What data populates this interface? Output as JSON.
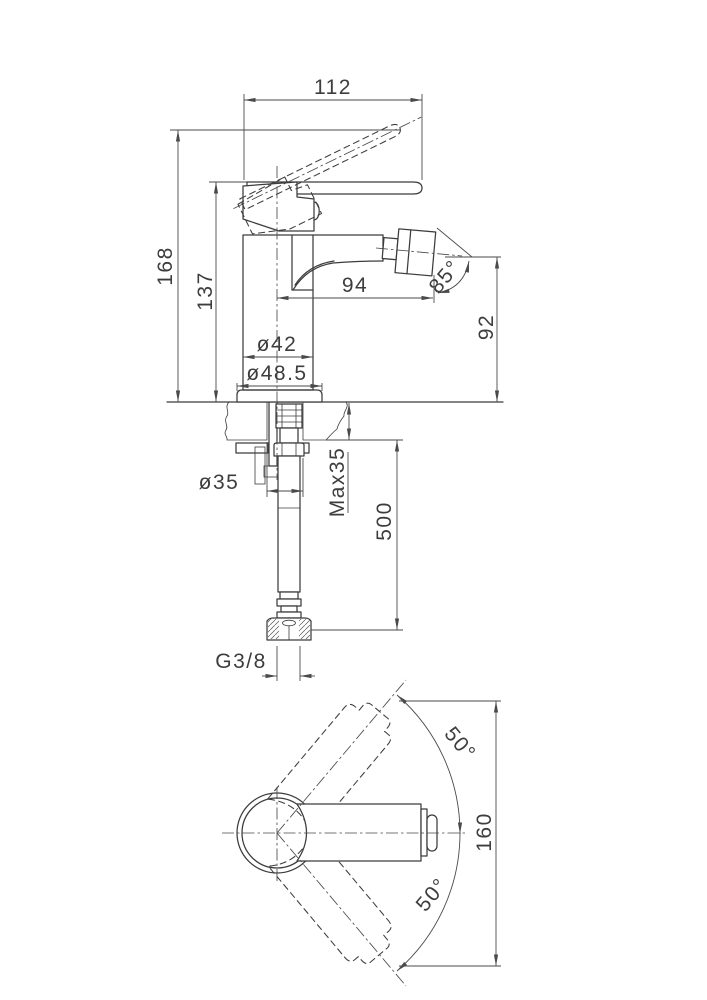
{
  "side_view": {
    "handle_projection": "112",
    "overall_height": "168",
    "height_to_handle": "137",
    "spout_reach": "94",
    "aerator_angle": "85°",
    "spout_height": "92",
    "body_diameter": "ø42",
    "base_diameter": "ø48.5"
  },
  "installation": {
    "hole_diameter": "ø35",
    "max_deck_thickness": "Max35",
    "hose_length": "500",
    "thread_size": "G3/8"
  },
  "top_view": {
    "handle_swing_upper": "50°",
    "handle_swing_lower": "50°",
    "swing_envelope": "160"
  }
}
